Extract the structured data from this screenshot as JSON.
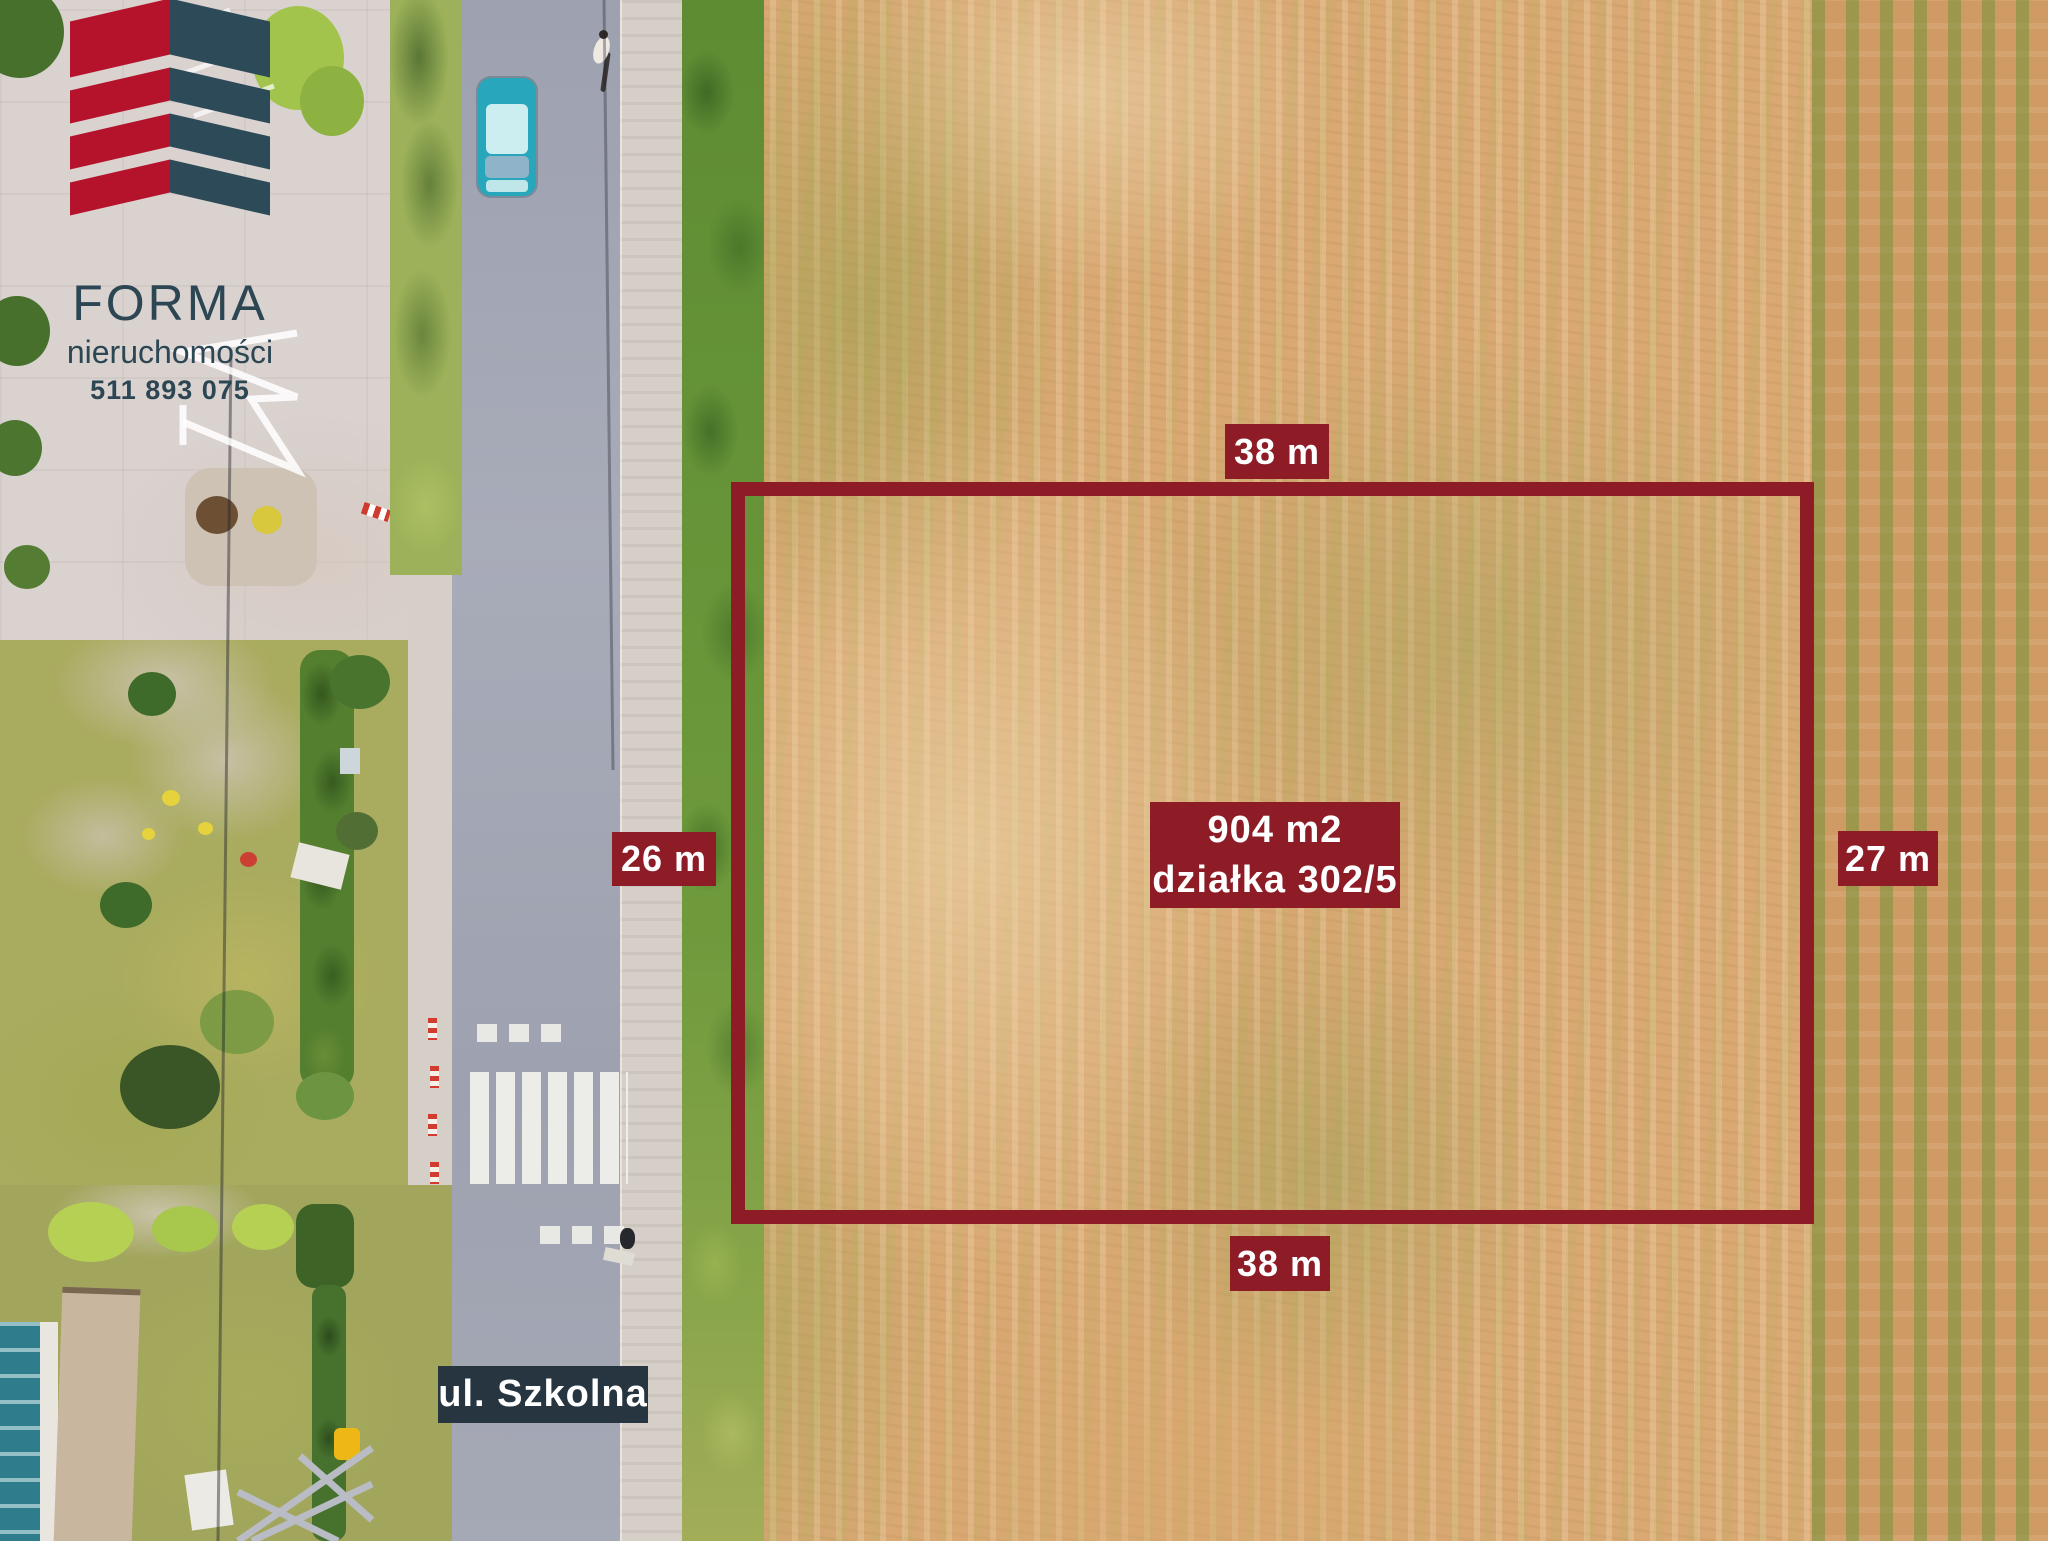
{
  "colors": {
    "annotation_maroon": "#8d1c26",
    "street_label_bg": "#26353f",
    "label_text": "#ffffff",
    "logo_red": "#b5132b",
    "logo_teal": "#2d4a59",
    "logo_text": "#2c4653"
  },
  "logo": {
    "brand": "FORMA",
    "subtitle": "nieruchomości",
    "phone": "511 893 075"
  },
  "annotations": {
    "top_width": "38 m",
    "bottom_width": "38 m",
    "left_depth": "26 m",
    "right_depth": "27 m",
    "area": "904 m2",
    "parcel": "działka 302/5",
    "street": "ul. Szkolna"
  }
}
